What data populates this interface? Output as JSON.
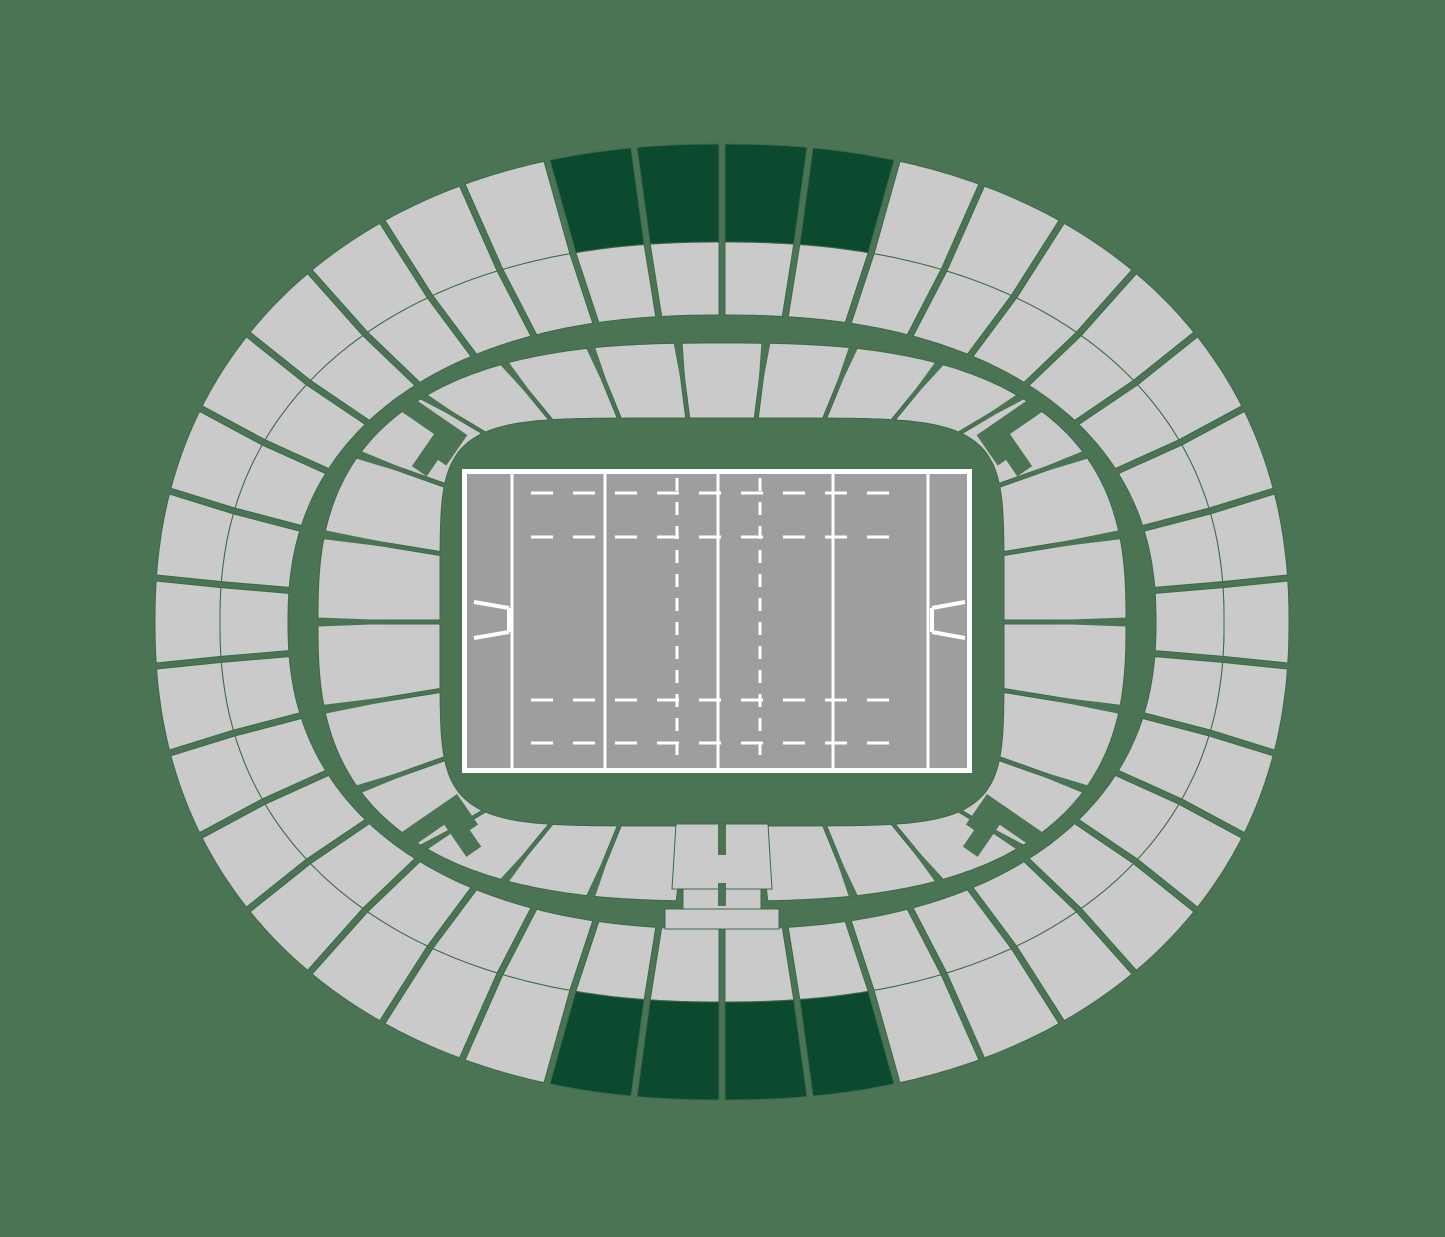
{
  "page": {
    "title": "Stadium seating map",
    "canvas": {
      "width": 1445,
      "height": 1237
    }
  },
  "colors": {
    "background": "#4b7455",
    "section_fill": "#c9cac9",
    "section_outline": "#3e684a",
    "highlight_fill": "#0c4a2f",
    "pitch_fill": "#9d9ea0",
    "pitch_line": "#ffffff"
  },
  "stadium": {
    "center": {
      "x": 722,
      "y": 622
    },
    "outer_ring": {
      "sections": 38,
      "gap_px": 3,
      "row_outer": {
        "a": 567,
        "b": 478,
        "n": 2.2
      },
      "row_split": {
        "a": 502,
        "b": 380,
        "n": 2.25
      },
      "row_inner": {
        "a": 434,
        "b": 307,
        "n": 2.3
      },
      "highlighted_sections": [
        36,
        37,
        0,
        1,
        17,
        18,
        19,
        20
      ]
    },
    "inner_bowl": {
      "sections": 26,
      "gap_px": 2,
      "spike_base_px": 9,
      "outer": {
        "a": 404,
        "b": 279,
        "n": 2.7
      },
      "inner": {
        "a": 282,
        "b": 204,
        "n": 6
      },
      "tunnel_section": 12
    },
    "vomitory_angles_deg": [
      45,
      135,
      225,
      315
    ],
    "vomitory_shape": [
      [
        -9,
        -8
      ],
      [
        9,
        -8
      ],
      [
        9,
        36
      ],
      [
        48,
        36
      ],
      [
        48,
        54
      ],
      [
        28,
        54
      ],
      [
        28,
        64
      ],
      [
        -9,
        64
      ]
    ],
    "tunnel": {
      "main": [
        [
          676,
          824
        ],
        [
          768,
          824
        ],
        [
          772,
          889
        ],
        [
          672,
          889
        ]
      ],
      "slot_top": {
        "x": 718,
        "y": 824,
        "w": 8,
        "h": 31
      },
      "mid": [
        [
          683,
          889
        ],
        [
          761,
          889
        ],
        [
          761,
          909
        ],
        [
          683,
          909
        ]
      ],
      "slot_mid": {
        "x": 718,
        "y": 883,
        "w": 8,
        "h": 23
      },
      "base": [
        [
          665,
          909
        ],
        [
          779,
          909
        ],
        [
          779,
          929
        ],
        [
          665,
          929
        ]
      ]
    }
  },
  "pitch": {
    "frame": {
      "x": 462,
      "y": 469,
      "w": 510,
      "h": 304
    },
    "field": {
      "x": 467,
      "y": 474,
      "w": 500,
      "h": 294
    },
    "solid_lines_x": [
      512,
      605,
      718,
      833,
      928
    ],
    "dashed_lines_x": [
      677,
      760
    ],
    "dashed_line_dash": "13 11",
    "dashed_rows_y": [
      493,
      537,
      700,
      743
    ],
    "dashed_row_x": [
      531,
      903
    ],
    "dashed_row_dash": "22 20",
    "line_width": 3,
    "posts": {
      "stroke_width": 4,
      "left": {
        "arms": [
          [
            [
              474,
              602
            ],
            [
              509,
              608
            ]
          ],
          [
            [
              474,
              638
            ],
            [
              509,
              632
            ]
          ]
        ],
        "bar": [
          [
            509,
            608
          ],
          [
            509,
            632
          ]
        ]
      },
      "right": {
        "arms": [
          [
            [
              965,
              602
            ],
            [
              932,
              608
            ]
          ],
          [
            [
              965,
              638
            ],
            [
              932,
              632
            ]
          ]
        ],
        "bar": [
          [
            932,
            608
          ],
          [
            932,
            632
          ]
        ]
      }
    }
  }
}
